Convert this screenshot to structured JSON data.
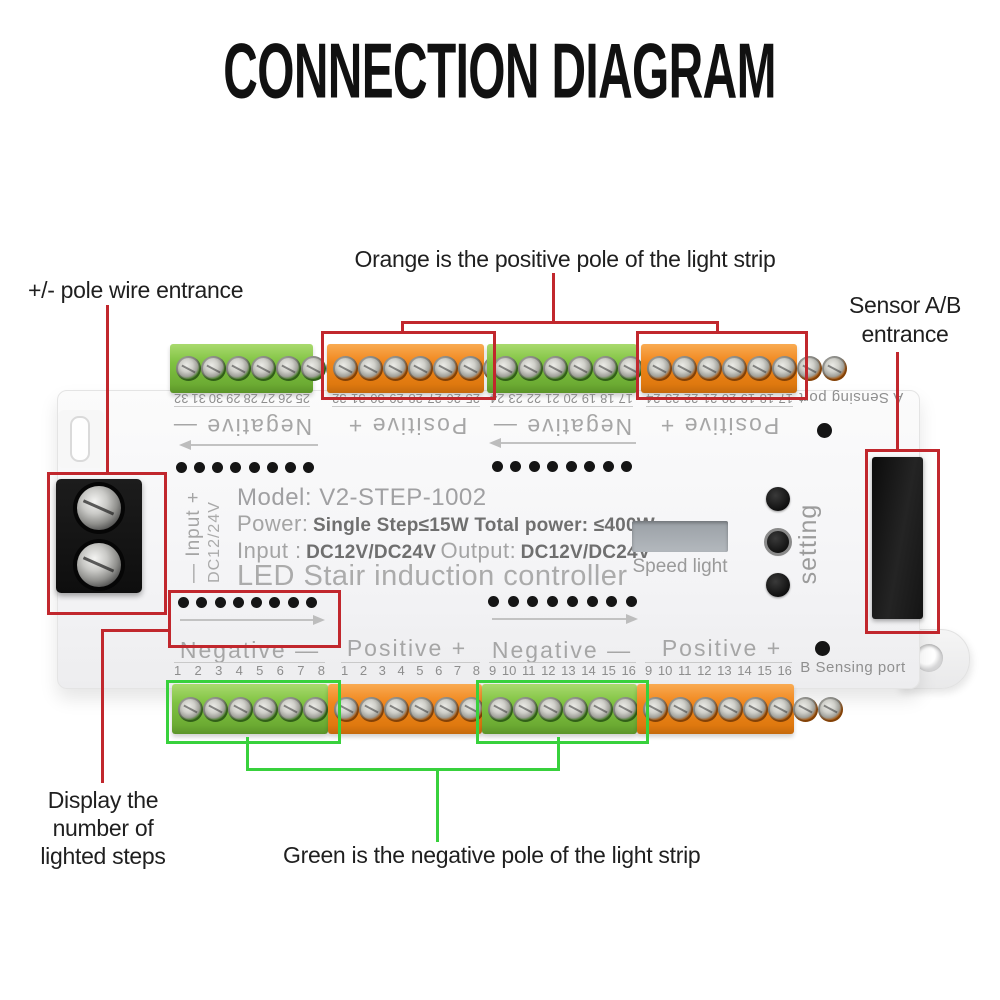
{
  "title": "CONNECTION DIAGRAM",
  "colors": {
    "annotation_red": "#c1272d",
    "annotation_green": "#38d13c",
    "terminal_green": "#7fc241",
    "terminal_orange": "#f0861c"
  },
  "annotations": {
    "orange_note": "Orange is the positive pole of the light strip",
    "pole_entrance": "+/- pole wire entrance",
    "sensor_entrance_line1": "Sensor A/B",
    "sensor_entrance_line2": "entrance",
    "display_note_line1": "Display the",
    "display_note_line2": "number of",
    "display_note_line3": "lighted steps",
    "green_note": "Green is the negative pole of the light strip"
  },
  "device": {
    "model": "Model: V2-STEP-1002",
    "power_label": "Power:",
    "power_value": "Single Step≤15W Total power: ≤400W",
    "input_label": "Input :",
    "input_value": "DC12V/DC24V",
    "output_label": "Output:",
    "output_value": "DC12V/DC24V",
    "product_name": "LED Stair induction controller",
    "display_label": "Speed light",
    "setting_label": "setting",
    "power_terminal_label": "— Input +",
    "power_voltage_label": "DC12/24V",
    "port_a_label": "A Sensing port",
    "port_b_label": "B Sensing port",
    "top_edge": {
      "sections": [
        {
          "color": "green",
          "polarity": "Negative —",
          "screws": 8,
          "numbers": [
            "25",
            "26",
            "27",
            "28",
            "29",
            "30",
            "31",
            "32"
          ]
        },
        {
          "color": "orange",
          "polarity": "Positive +",
          "screws": 8,
          "numbers": [
            "25",
            "26",
            "27",
            "28",
            "29",
            "30",
            "31",
            "32"
          ]
        },
        {
          "color": "green",
          "polarity": "Negative —",
          "screws": 8,
          "numbers": [
            "17",
            "18",
            "19",
            "20",
            "21",
            "22",
            "23",
            "24"
          ]
        },
        {
          "color": "orange",
          "polarity": "Positive +",
          "screws": 8,
          "numbers": [
            "17",
            "18",
            "19",
            "20",
            "21",
            "22",
            "23",
            "24"
          ]
        }
      ]
    },
    "bottom_edge": {
      "sections": [
        {
          "color": "green",
          "polarity": "Negative —",
          "screws": 8,
          "numbers": [
            "1",
            "2",
            "3",
            "4",
            "5",
            "6",
            "7",
            "8"
          ]
        },
        {
          "color": "orange",
          "polarity": "Positive +",
          "screws": 8,
          "numbers": [
            "1",
            "2",
            "3",
            "4",
            "5",
            "6",
            "7",
            "8"
          ]
        },
        {
          "color": "green",
          "polarity": "Negative —",
          "screws": 8,
          "numbers": [
            "9",
            "10",
            "11",
            "12",
            "13",
            "14",
            "15",
            "16"
          ]
        },
        {
          "color": "orange",
          "polarity": "Positive +",
          "screws": 8,
          "numbers": [
            "9",
            "10",
            "11",
            "12",
            "13",
            "14",
            "15",
            "16"
          ]
        }
      ]
    },
    "led_rows": {
      "top_left": 8,
      "top_right": 8,
      "bottom_left": 8,
      "bottom_right": 8
    },
    "power_terminal_screws": 2,
    "setting_buttons": 3
  }
}
